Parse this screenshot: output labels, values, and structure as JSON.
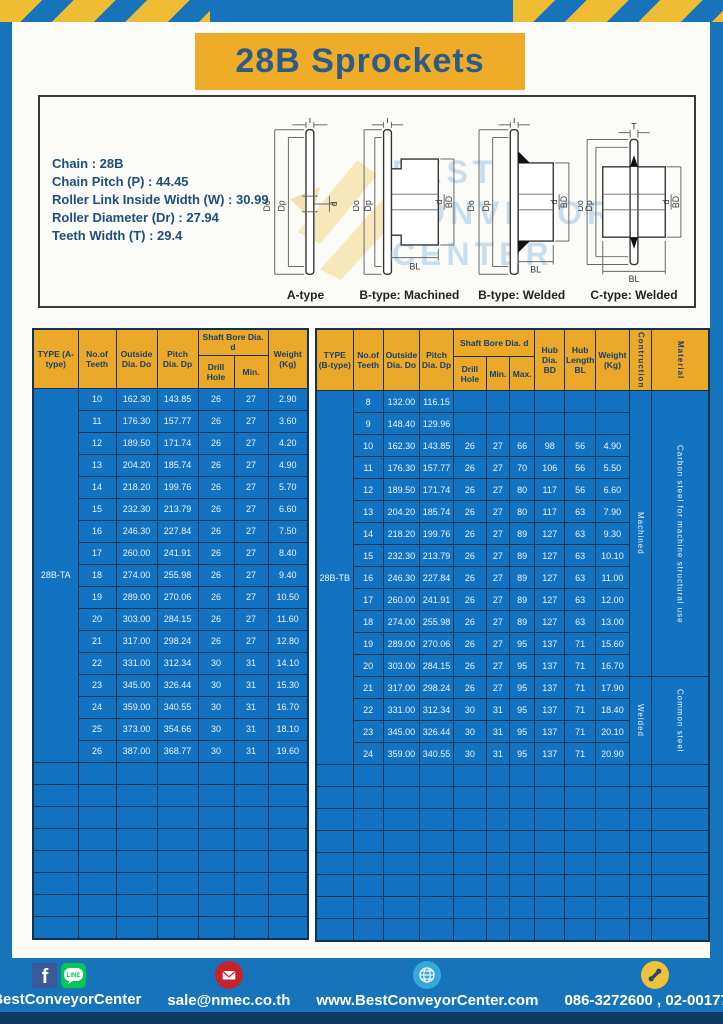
{
  "title": "28B Sprockets",
  "colors": {
    "brand_blue": "#1774bb",
    "accent_yellow": "#efac28",
    "table_blue": "#1173c1",
    "header_yellow": "#eba829",
    "navy_text": "#2d5b86",
    "bottom_navy": "#0e3b63"
  },
  "specs": {
    "l1": "Chain : 28B",
    "l2": "Chain Pitch (P) : 44.45",
    "l3": "Roller Link Inside Width (W) : 30.99",
    "l4": "Roller Diameter (Dr) : 27.94",
    "l5": "Teeth Width (T) : 29.4"
  },
  "diagram": {
    "watermark_lines": [
      "BEST",
      "CONVEYOR",
      "CENTER"
    ],
    "dims": {
      "T": "T",
      "Do": "Do",
      "Dp": "Dp",
      "d": "d",
      "BD": "BD",
      "BL": "BL"
    },
    "types": [
      "A-type",
      "B-type: Machined",
      "B-type: Welded",
      "C-type: Welded"
    ]
  },
  "table_a": {
    "type_label": "28B-TA",
    "headers": {
      "type": "TYPE (A-type)",
      "teeth": "No.of Teeth",
      "outside": "Outside Dia. Do",
      "pitch": "Pitch Dia. Dp",
      "bore_group": "Shaft Bore Dia. d",
      "drill": "Drill Hole",
      "min": "Min.",
      "weight": "Weight (Kg)"
    },
    "rows": [
      [
        "10",
        "162.30",
        "143.85",
        "26",
        "27",
        "2.90"
      ],
      [
        "11",
        "176.30",
        "157.77",
        "26",
        "27",
        "3.60"
      ],
      [
        "12",
        "189.50",
        "171.74",
        "26",
        "27",
        "4.20"
      ],
      [
        "13",
        "204.20",
        "185.74",
        "26",
        "27",
        "4.90"
      ],
      [
        "14",
        "218.20",
        "199.76",
        "26",
        "27",
        "5.70"
      ],
      [
        "15",
        "232.30",
        "213.79",
        "26",
        "27",
        "6.60"
      ],
      [
        "16",
        "246.30",
        "227.84",
        "26",
        "27",
        "7.50"
      ],
      [
        "17",
        "260.00",
        "241.91",
        "26",
        "27",
        "8.40"
      ],
      [
        "18",
        "274.00",
        "255.98",
        "26",
        "27",
        "9.40"
      ],
      [
        "19",
        "289.00",
        "270.06",
        "26",
        "27",
        "10.50"
      ],
      [
        "20",
        "303.00",
        "284.15",
        "26",
        "27",
        "11.60"
      ],
      [
        "21",
        "317.00",
        "298.24",
        "26",
        "27",
        "12.80"
      ],
      [
        "22",
        "331.00",
        "312.34",
        "30",
        "31",
        "14.10"
      ],
      [
        "23",
        "345.00",
        "326.44",
        "30",
        "31",
        "15.30"
      ],
      [
        "24",
        "359.00",
        "340.55",
        "30",
        "31",
        "16.70"
      ],
      [
        "25",
        "373.00",
        "354.66",
        "30",
        "31",
        "18.10"
      ],
      [
        "26",
        "387.00",
        "368.77",
        "30",
        "31",
        "19.60"
      ]
    ],
    "empty_rows": 8
  },
  "table_b": {
    "type_label": "28B-TB",
    "headers": {
      "type": "TYPE (B-type)",
      "teeth": "No.of Teeth",
      "outside": "Outside Dia. Do",
      "pitch": "Pitch Dia. Dp",
      "bore_group": "Shaft Bore Dia. d",
      "drill": "Drill Hole",
      "min": "Min.",
      "max": "Max.",
      "hub_dia": "Hub Dia. BD",
      "hub_len": "Hub Length BL",
      "weight": "Weight (Kg)",
      "construction": "Contruction",
      "material": "Material"
    },
    "rows": [
      [
        "8",
        "132.00",
        "116.15",
        "",
        "",
        "",
        "",
        "",
        ""
      ],
      [
        "9",
        "148.40",
        "129.96",
        "",
        "",
        "",
        "",
        "",
        ""
      ],
      [
        "10",
        "162.30",
        "143.85",
        "26",
        "27",
        "66",
        "98",
        "56",
        "4.90"
      ],
      [
        "11",
        "176.30",
        "157.77",
        "26",
        "27",
        "70",
        "106",
        "56",
        "5.50"
      ],
      [
        "12",
        "189.50",
        "171.74",
        "26",
        "27",
        "80",
        "117",
        "56",
        "6.60"
      ],
      [
        "13",
        "204.20",
        "185.74",
        "26",
        "27",
        "80",
        "117",
        "63",
        "7.90"
      ],
      [
        "14",
        "218.20",
        "199.76",
        "26",
        "27",
        "89",
        "127",
        "63",
        "9.30"
      ],
      [
        "15",
        "232.30",
        "213.79",
        "26",
        "27",
        "89",
        "127",
        "63",
        "10.10"
      ],
      [
        "16",
        "246.30",
        "227.84",
        "26",
        "27",
        "89",
        "127",
        "63",
        "11.00"
      ],
      [
        "17",
        "260.00",
        "241.91",
        "26",
        "27",
        "89",
        "127",
        "63",
        "12.00"
      ],
      [
        "18",
        "274.00",
        "255.98",
        "26",
        "27",
        "89",
        "127",
        "63",
        "13.00"
      ],
      [
        "19",
        "289.00",
        "270.06",
        "26",
        "27",
        "95",
        "137",
        "71",
        "15.60"
      ],
      [
        "20",
        "303.00",
        "284.15",
        "26",
        "27",
        "95",
        "137",
        "71",
        "16.70"
      ],
      [
        "21",
        "317.00",
        "298.24",
        "26",
        "27",
        "95",
        "137",
        "71",
        "17.90"
      ],
      [
        "22",
        "331.00",
        "312.34",
        "30",
        "31",
        "95",
        "137",
        "71",
        "18.40"
      ],
      [
        "23",
        "345.00",
        "326.44",
        "30",
        "31",
        "95",
        "137",
        "71",
        "20.10"
      ],
      [
        "24",
        "359.00",
        "340.55",
        "30",
        "31",
        "95",
        "137",
        "71",
        "20.90"
      ]
    ],
    "spans": [
      {
        "row": 0,
        "span": 13,
        "construction": "Machined",
        "material": "Carbon steel for machine structural use"
      },
      {
        "row": 13,
        "span": 4,
        "construction": "Welded",
        "material": "Common steel"
      }
    ],
    "empty_rows": 8
  },
  "footer": {
    "fb_label": "f",
    "line_label": "LINE",
    "handle": "@BestConveyorCenter",
    "email": "sale@nmec.co.th",
    "website": "www.BestConveyorCenter.com",
    "phones": "086-3272600 , 02-0017766"
  }
}
